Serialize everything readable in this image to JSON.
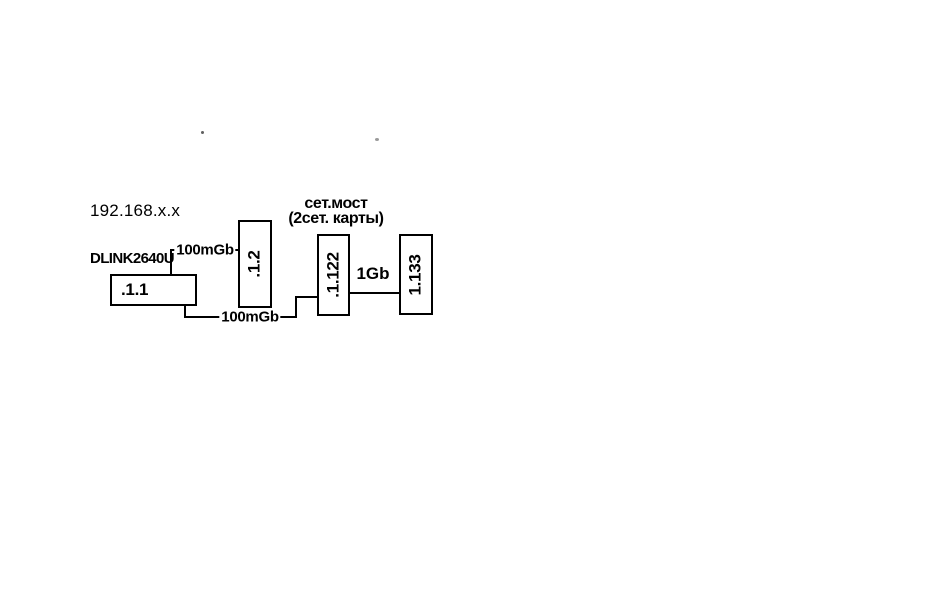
{
  "network": {
    "subnet_label": "192.168.x.x"
  },
  "devices": {
    "router": {
      "name": "DLINK2640U",
      "ip": ".1.1"
    },
    "pc_top": {
      "ip": ".1.2"
    },
    "bridge": {
      "ip": ".1.122",
      "caption_line1": "сет.мост",
      "caption_line2": "(2сет. карты)"
    },
    "pc_right": {
      "ip": "1.133"
    }
  },
  "links": {
    "router_to_pc_top": {
      "label": "100mGb"
    },
    "router_to_bridge": {
      "label": "100mGb"
    },
    "bridge_to_pc_right": {
      "label": "1Gb"
    }
  },
  "colors": {
    "line": "#000000",
    "background": "#ffffff",
    "text": "#000000"
  }
}
